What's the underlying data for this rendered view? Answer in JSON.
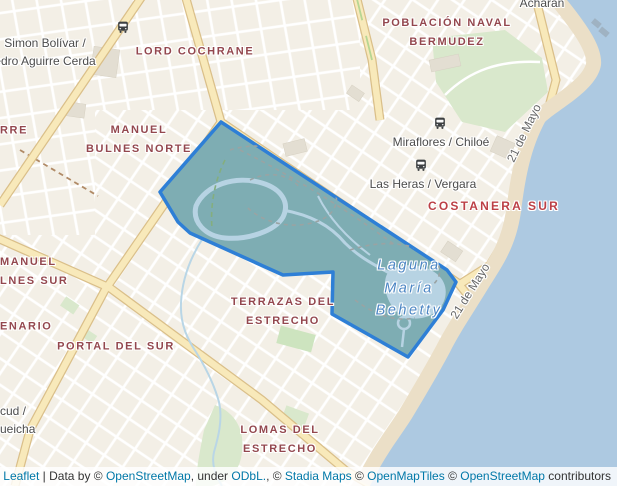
{
  "map": {
    "colors": {
      "land": "#f3efe6",
      "water": "#adc9e1",
      "road_fill": "#f8e9ba",
      "road_casing": "#d9bd85",
      "park": "#d9e8cc",
      "beach": "#ebdfc7",
      "district_text": "#93474e",
      "district_major_text": "#bc4046",
      "street_text": "#4c4c4c",
      "water_name_text": "#4c86c4",
      "link": "#0078a8",
      "highlight_stroke": "#2e7fd6",
      "highlight_fill": "#7eadb3"
    },
    "highlight_polygon": {
      "name": "parque-maria-behety-selection",
      "points": [
        [
          221,
          122
        ],
        [
          447,
          270
        ],
        [
          456,
          282
        ],
        [
          443,
          310
        ],
        [
          408,
          357
        ],
        [
          332,
          314
        ],
        [
          333,
          272
        ],
        [
          283,
          275
        ],
        [
          190,
          233
        ],
        [
          178,
          222
        ],
        [
          160,
          192
        ]
      ]
    },
    "labels": [
      {
        "name": "label-lord-cochrane",
        "type": "district",
        "x": 195,
        "y": 52,
        "lines": [
          "LORD COCHRANE"
        ]
      },
      {
        "name": "label-poblacion-naval-bermudez",
        "type": "district",
        "x": 447,
        "y": 33,
        "lines": [
          "POBLACIÓN NAVAL",
          "BERMUDEZ"
        ]
      },
      {
        "name": "label-manuel-bulnes-norte",
        "type": "district",
        "x": 139,
        "y": 140,
        "lines": [
          "MANUEL",
          "BULNES NORTE"
        ]
      },
      {
        "name": "label-rre-fragment",
        "type": "district",
        "x": 0,
        "y": 131,
        "align": "left",
        "lines": [
          "RRE"
        ]
      },
      {
        "name": "label-manuel-bulnes-sur",
        "type": "district",
        "x": 0,
        "y": 272,
        "align": "left",
        "lines": [
          "MANUEL",
          "LNES SUR"
        ]
      },
      {
        "name": "label-enario-fragment",
        "type": "district",
        "x": 0,
        "y": 327,
        "align": "left",
        "lines": [
          "ENARIO"
        ]
      },
      {
        "name": "label-portal-del-sur",
        "type": "district",
        "x": 116,
        "y": 347,
        "lines": [
          "PORTAL DEL SUR"
        ]
      },
      {
        "name": "label-terrazas-del-estrecho",
        "type": "district",
        "x": 283,
        "y": 312,
        "lines": [
          "TERRAZAS DEL",
          "ESTRECHO"
        ]
      },
      {
        "name": "label-costanera-sur",
        "type": "district-major",
        "x": 494,
        "y": 206,
        "lines": [
          "COSTANERA SUR"
        ]
      },
      {
        "name": "label-lomas-del-estrecho",
        "type": "district",
        "x": 280,
        "y": 440,
        "lines": [
          "LOMAS DEL",
          "ESTRECHO"
        ]
      },
      {
        "name": "bus-stop-simon-bolivar-pedro-aguirre-cerda",
        "type": "street",
        "x": 45,
        "y": 52,
        "lines": [
          "Simon Bolívar /",
          "edro Aguirre Cerda"
        ],
        "icon": "bus",
        "icon_x": 123,
        "icon_y": 27
      },
      {
        "name": "bus-stop-miraflores-chiloe",
        "type": "street",
        "x": 441,
        "y": 142,
        "lines": [
          "Miraflores / Chiloé"
        ],
        "icon": "bus",
        "icon_x": 440,
        "icon_y": 123
      },
      {
        "name": "bus-stop-las-heras-vergara",
        "type": "street",
        "x": 423,
        "y": 184,
        "lines": [
          "Las Heras / Vergara"
        ],
        "icon": "bus",
        "icon_x": 421,
        "icon_y": 165
      },
      {
        "name": "label-acharan",
        "type": "street",
        "x": 542,
        "y": 3,
        "lines": [
          "Acharán"
        ]
      },
      {
        "name": "label-bus-stop-fragment",
        "type": "street",
        "x": 0,
        "y": 420,
        "align": "left",
        "lines": [
          "cud /",
          "ueicha"
        ]
      },
      {
        "name": "label-21-de-mayo-north",
        "type": "street-rot",
        "x": 524,
        "y": 133,
        "rot": -64,
        "lines": [
          "21 de Mayo"
        ]
      },
      {
        "name": "label-21-de-mayo-south",
        "type": "street-rot",
        "x": 470,
        "y": 291,
        "rot": -58,
        "lines": [
          "21 de Mayo"
        ]
      },
      {
        "name": "label-laguna-maria-behetty",
        "type": "water-name",
        "x": 409,
        "y": 288,
        "lines": [
          "Laguna",
          "María",
          "Behetty"
        ]
      }
    ]
  },
  "attribution": {
    "parts": [
      {
        "text": "Leaflet",
        "link": true,
        "name": "attribution-link-leaflet"
      },
      {
        "text": " | Data by © "
      },
      {
        "text": "OpenStreetMap",
        "link": true,
        "name": "attribution-link-openstreetmap-1"
      },
      {
        "text": ", under "
      },
      {
        "text": "ODbL.",
        "link": true,
        "name": "attribution-link-odbl"
      },
      {
        "text": ", © "
      },
      {
        "text": "Stadia Maps",
        "link": true,
        "name": "attribution-link-stadia-maps"
      },
      {
        "text": " © "
      },
      {
        "text": "OpenMapTiles",
        "link": true,
        "name": "attribution-link-openmaptiles"
      },
      {
        "text": " © "
      },
      {
        "text": "OpenStreetMap",
        "link": true,
        "name": "attribution-link-openstreetmap-2"
      },
      {
        "text": " contributors"
      }
    ]
  }
}
